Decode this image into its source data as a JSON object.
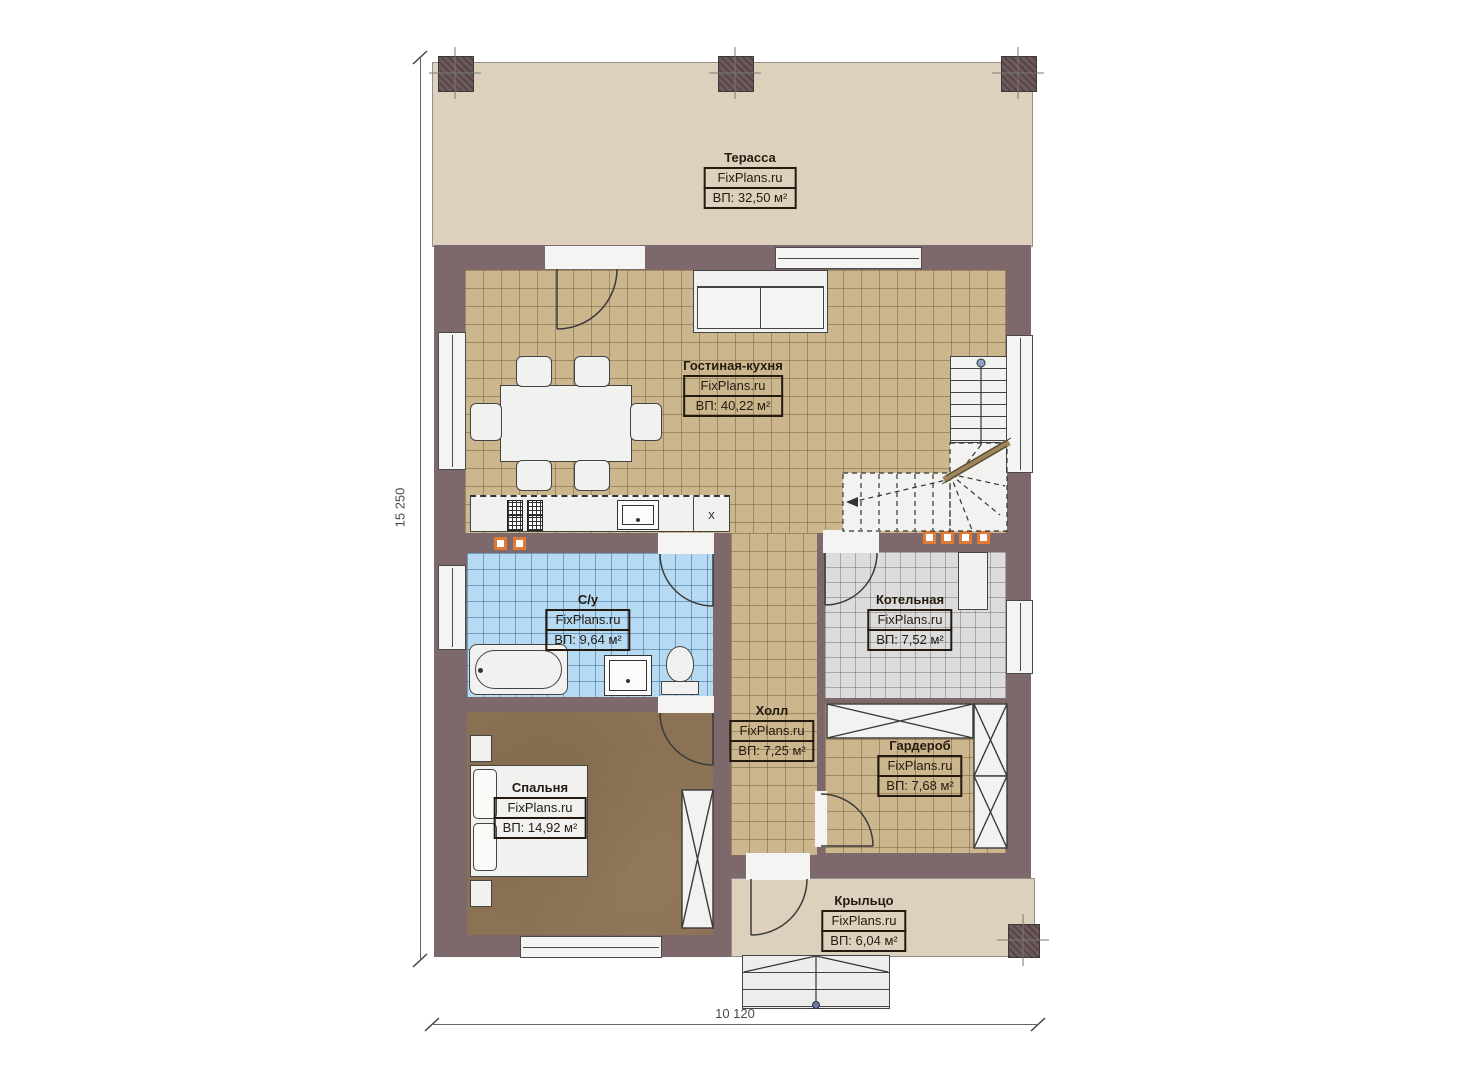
{
  "plan": {
    "rooms": [
      {
        "id": "terrace",
        "name": "Терасса",
        "brand": "FixPlans.ru",
        "area": "ВП: 32,50 м²"
      },
      {
        "id": "living-kitchen",
        "name": "Гостиная-кухня",
        "brand": "FixPlans.ru",
        "area": "ВП: 40,22 м²"
      },
      {
        "id": "bathroom",
        "name": "С/у",
        "brand": "FixPlans.ru",
        "area": "ВП: 9,64 м²"
      },
      {
        "id": "boiler",
        "name": "Котельная",
        "brand": "FixPlans.ru",
        "area": "ВП: 7,52 м²"
      },
      {
        "id": "hall",
        "name": "Холл",
        "brand": "FixPlans.ru",
        "area": "ВП: 7,25 м²"
      },
      {
        "id": "wardrobe",
        "name": "Гардероб",
        "brand": "FixPlans.ru",
        "area": "ВП: 7,68 м²"
      },
      {
        "id": "bedroom",
        "name": "Спальня",
        "brand": "FixPlans.ru",
        "area": "ВП: 14,92 м²"
      },
      {
        "id": "porch",
        "name": "Крыльцо",
        "brand": "FixPlans.ru",
        "area": "ВП: 6,04 м²"
      }
    ],
    "dimensions": {
      "left": "15 250",
      "bottom": "10 120"
    },
    "kitchen": {
      "cabinet_mark": "x"
    },
    "colors": {
      "wall": "#7d696b",
      "terrace_floor": "#ddd0bc",
      "tile_tan": "#ccb68e",
      "tile_blue": "#b7daf3",
      "tile_gray": "#dcdcdc",
      "bedroom_floor": "#8c7254",
      "vent_orange": "#e07a36"
    }
  }
}
